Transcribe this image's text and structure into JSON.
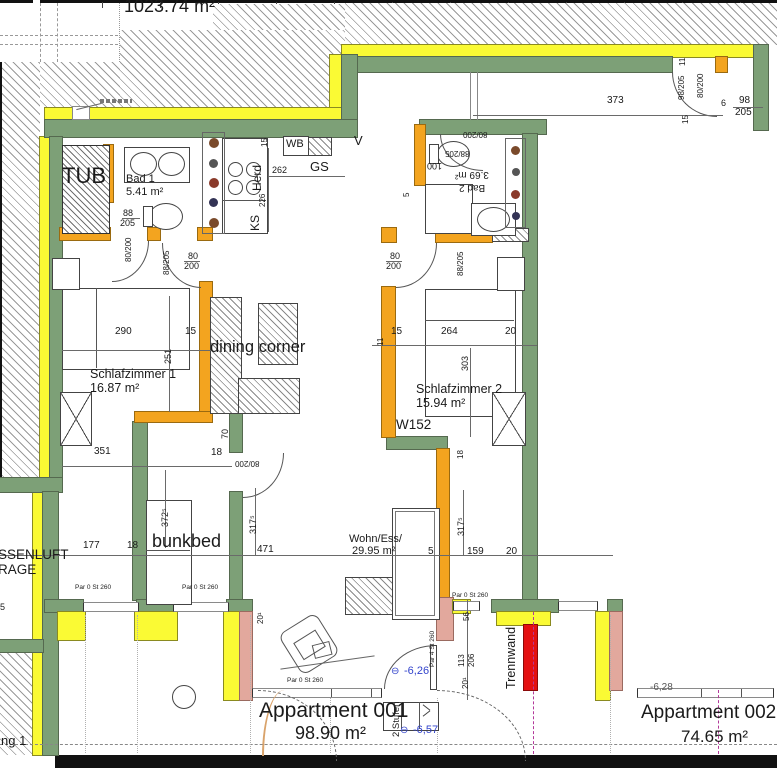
{
  "plan_title": "Apartment floor plan",
  "colors": {
    "wall_green": "#7da077",
    "insulation_yellow": "#fafa34",
    "interior_orange": "#f3a41f",
    "pier_salmon": "#e2a89d",
    "trennwand_red": "#e41112",
    "elevation_blue": "#3344cc"
  },
  "labels": [
    {
      "name": "total-area-label",
      "text": "1023.74 m²",
      "x": 124,
      "y": -3,
      "fs": 18
    },
    {
      "name": "tub-label",
      "text": "TUB",
      "x": 62,
      "y": 165,
      "fs": 22
    },
    {
      "name": "bad1-name",
      "text": "Bad 1",
      "x": 126,
      "y": 174,
      "fs": 11
    },
    {
      "name": "bad1-area",
      "text": "5.41 m²",
      "x": 126,
      "y": 187,
      "fs": 11
    },
    {
      "name": "wb-label",
      "text": "WB",
      "x": 286,
      "y": 139,
      "fs": 11
    },
    {
      "name": "gs-label",
      "text": "GS",
      "x": 310,
      "y": 160,
      "fs": 13
    },
    {
      "name": "herd-label",
      "text": "Herd",
      "x": 251,
      "y": 191,
      "fs": 12,
      "rot": -90
    },
    {
      "name": "ks-label",
      "text": "KS",
      "x": 249,
      "y": 231,
      "fs": 12,
      "rot": -90
    },
    {
      "name": "vent-mark",
      "text": "V",
      "x": 354,
      "y": 134,
      "fs": 13
    },
    {
      "name": "bad2-area",
      "text": "3.69 m²",
      "x": 455,
      "y": 169,
      "fs": 10,
      "rot": 180
    },
    {
      "name": "bad2-name",
      "text": "Bad 2",
      "x": 459,
      "y": 182,
      "fs": 10,
      "rot": 180
    },
    {
      "name": "schlafzimmer1-name",
      "text": "Schlafzimmer 1",
      "x": 90,
      "y": 368,
      "fs": 12.5
    },
    {
      "name": "schlafzimmer1-area",
      "text": "16.87 m²",
      "x": 90,
      "y": 382,
      "fs": 12.5
    },
    {
      "name": "schlafzimmer2-name",
      "text": "Schlafzimmer 2",
      "x": 416,
      "y": 383,
      "fs": 12.5
    },
    {
      "name": "schlafzimmer2-area",
      "text": "15.94 m²",
      "x": 416,
      "y": 397,
      "fs": 12.5
    },
    {
      "name": "w152-label",
      "text": "W152",
      "x": 396,
      "y": 418,
      "fs": 13.5
    },
    {
      "name": "dining-corner-label",
      "text": "dining corner",
      "x": 210,
      "y": 339,
      "fs": 16.5
    },
    {
      "name": "bunkbed-label",
      "text": "bunkbed",
      "x": 152,
      "y": 532,
      "fs": 18
    },
    {
      "name": "wohness-name",
      "text": "Wohn/Ess/",
      "x": 349,
      "y": 534,
      "fs": 11
    },
    {
      "name": "wohness-area",
      "text": "29.95 m²",
      "x": 352,
      "y": 546,
      "fs": 11
    },
    {
      "name": "aussenluft-label",
      "text": "SSENLUFT",
      "x": -2,
      "y": 548,
      "fs": 13.5
    },
    {
      "name": "garage-label",
      "text": "RAGE",
      "x": -2,
      "y": 563,
      "fs": 13.5
    },
    {
      "name": "trennwand-label",
      "text": "Trennwand",
      "x": 505,
      "y": 689,
      "fs": 12.5,
      "rot": -90
    },
    {
      "name": "stufen-label",
      "text": "2 Stufen",
      "x": 392,
      "y": 737,
      "fs": 9.5,
      "rot": -90
    },
    {
      "name": "apartment1-name",
      "text": "Appartment 001",
      "x": 259,
      "y": 700,
      "fs": 21
    },
    {
      "name": "apartment1-area",
      "text": "98.90 m²",
      "x": 295,
      "y": 724,
      "fs": 18
    },
    {
      "name": "apartment2-name",
      "text": "Appartment 002",
      "x": 641,
      "y": 703,
      "fs": 19
    },
    {
      "name": "apartment2-area",
      "text": "74.65 m²",
      "x": 681,
      "y": 728,
      "fs": 17
    },
    {
      "name": "wohnung-label",
      "text": "ng 1",
      "x": 1,
      "y": 734,
      "fs": 13
    },
    {
      "name": "elevation1-symbol",
      "text": "⊖",
      "x": 391,
      "y": 667,
      "fs": 10,
      "color": "#3344cc"
    },
    {
      "name": "elevation1",
      "text": "-6,26",
      "x": 404,
      "y": 666,
      "fs": 11,
      "color": "#3344cc"
    },
    {
      "name": "elevation2-symbol",
      "text": "⊖",
      "x": 400,
      "y": 726,
      "fs": 10,
      "color": "#3344cc"
    },
    {
      "name": "elevation2",
      "text": "-6,57",
      "x": 413,
      "y": 725,
      "fs": 11,
      "color": "#3344cc"
    },
    {
      "name": "elevation3",
      "text": "-6,28",
      "x": 650,
      "y": 683,
      "fs": 10,
      "color": "#555555"
    },
    {
      "name": "parapet1",
      "text": "Par 0 St 260",
      "x": 75,
      "y": 585,
      "fs": 6.5
    },
    {
      "name": "parapet2",
      "text": "Par 0 St 260",
      "x": 182,
      "y": 585,
      "fs": 6.5
    },
    {
      "name": "parapet3",
      "text": "Par 0 St 260",
      "x": 287,
      "y": 678,
      "fs": 6.5
    },
    {
      "name": "parapet4",
      "text": "Par 0 St 260",
      "x": 452,
      "y": 593,
      "fs": 6.5
    },
    {
      "name": "parapet5",
      "text": "Par 4 St 260",
      "x": 430,
      "y": 667,
      "fs": 6.5,
      "rot": -90
    }
  ],
  "dims": [
    {
      "name": "dim-373",
      "text": "373",
      "x": 607,
      "y": 96,
      "fs": 10
    },
    {
      "name": "dim-98-right",
      "text": "98",
      "x": 739,
      "y": 96,
      "fs": 10
    },
    {
      "name": "dim-205-right",
      "text": "205",
      "x": 735,
      "y": 108,
      "fs": 10
    },
    {
      "name": "dim-6",
      "text": "6",
      "x": 721,
      "y": 99,
      "fs": 9
    },
    {
      "name": "dim-door-98-205",
      "text": "98/205",
      "x": 678,
      "y": 100,
      "fs": 8,
      "rot": -90
    },
    {
      "name": "dim-door-80-200-top",
      "text": "80/200",
      "x": 697,
      "y": 98,
      "fs": 8,
      "rot": -90
    },
    {
      "name": "dim-15-top",
      "text": "15",
      "x": 682,
      "y": 124,
      "fs": 8,
      "rot": -90
    },
    {
      "name": "dim-11-top",
      "text": "11",
      "x": 679,
      "y": 66,
      "fs": 8,
      "rot": -90
    },
    {
      "name": "dim-15-kitchen",
      "text": "15",
      "x": 261,
      "y": 147,
      "fs": 8,
      "rot": -90
    },
    {
      "name": "dim-262",
      "text": "262",
      "x": 272,
      "y": 166,
      "fs": 9
    },
    {
      "name": "dim-226",
      "text": "226",
      "x": 259,
      "y": 207,
      "fs": 8,
      "rot": -90
    },
    {
      "name": "dim-88-bad1",
      "text": "88",
      "x": 123,
      "y": 209,
      "fs": 9
    },
    {
      "name": "dim-205-bad1",
      "text": "205",
      "x": 120,
      "y": 219,
      "fs": 9
    },
    {
      "name": "dim-80-200-bad1",
      "text": "80/200",
      "x": 125,
      "y": 262,
      "fs": 8,
      "rot": -90
    },
    {
      "name": "dim-88-205-s1",
      "text": "88/205",
      "x": 163,
      "y": 275,
      "fs": 8,
      "rot": -90
    },
    {
      "name": "dim-80-s1",
      "text": "80",
      "x": 188,
      "y": 252,
      "fs": 9
    },
    {
      "name": "dim-200-s1",
      "text": "200",
      "x": 184,
      "y": 262,
      "fs": 9
    },
    {
      "name": "dim-290",
      "text": "290",
      "x": 115,
      "y": 327,
      "fs": 10
    },
    {
      "name": "dim-251",
      "text": "251",
      "x": 164,
      "y": 364,
      "fs": 9,
      "rot": -90
    },
    {
      "name": "dim-15-s1",
      "text": "15",
      "x": 185,
      "y": 327,
      "fs": 10
    },
    {
      "name": "dim-351",
      "text": "351",
      "x": 94,
      "y": 447,
      "fs": 10
    },
    {
      "name": "dim-18-s1",
      "text": "18",
      "x": 211,
      "y": 448,
      "fs": 10
    },
    {
      "name": "dim-372-5",
      "text": "372⁵",
      "x": 161,
      "y": 527,
      "fs": 9,
      "rot": -90
    },
    {
      "name": "dim-177",
      "text": "177",
      "x": 83,
      "y": 541,
      "fs": 10
    },
    {
      "name": "dim-18-hall",
      "text": "18",
      "x": 127,
      "y": 541,
      "fs": 10
    },
    {
      "name": "dim-471",
      "text": "471",
      "x": 257,
      "y": 545,
      "fs": 10
    },
    {
      "name": "dim-70",
      "text": "70",
      "x": 221,
      "y": 439,
      "fs": 9,
      "rot": -90
    },
    {
      "name": "dim-80-200-hall",
      "text": "80/200",
      "x": 235,
      "y": 459,
      "fs": 8,
      "rot": 180
    },
    {
      "name": "dim-317-5-left",
      "text": "317⁵",
      "x": 249,
      "y": 534,
      "fs": 9,
      "rot": -90
    },
    {
      "name": "dim-20-1-left",
      "text": "20¹",
      "x": 257,
      "y": 624,
      "fs": 8,
      "rot": -90
    },
    {
      "name": "dim-5-win",
      "text": "5",
      "x": 428,
      "y": 547,
      "fs": 10
    },
    {
      "name": "dim-159",
      "text": "159",
      "x": 467,
      "y": 547,
      "fs": 10
    },
    {
      "name": "dim-20-right",
      "text": "20",
      "x": 506,
      "y": 547,
      "fs": 10
    },
    {
      "name": "dim-317-5-right",
      "text": "317⁵",
      "x": 457,
      "y": 536,
      "fs": 9,
      "rot": -90
    },
    {
      "name": "dim-56",
      "text": "56",
      "x": 463,
      "y": 621,
      "fs": 8,
      "rot": -90
    },
    {
      "name": "dim-113",
      "text": "113",
      "x": 458,
      "y": 667,
      "fs": 8,
      "rot": -90
    },
    {
      "name": "dim-206",
      "text": "206",
      "x": 468,
      "y": 667,
      "fs": 8,
      "rot": -90
    },
    {
      "name": "dim-20-1-mid",
      "text": "20¹",
      "x": 462,
      "y": 689,
      "fs": 8,
      "rot": -90
    },
    {
      "name": "dim-15-s2",
      "text": "15",
      "x": 391,
      "y": 327,
      "fs": 10
    },
    {
      "name": "dim-264",
      "text": "264",
      "x": 441,
      "y": 327,
      "fs": 10
    },
    {
      "name": "dim-20-s2",
      "text": "20",
      "x": 505,
      "y": 327,
      "fs": 10
    },
    {
      "name": "dim-11-s2",
      "text": "11",
      "x": 377,
      "y": 346,
      "fs": 8,
      "rot": -90
    },
    {
      "name": "dim-303",
      "text": "303",
      "x": 461,
      "y": 371,
      "fs": 9,
      "rot": -90
    },
    {
      "name": "dim-80-s2",
      "text": "80",
      "x": 390,
      "y": 252,
      "fs": 9
    },
    {
      "name": "dim-200-s2",
      "text": "200",
      "x": 386,
      "y": 262,
      "fs": 9
    },
    {
      "name": "dim-88-205-s2",
      "text": "88/205",
      "x": 457,
      "y": 276,
      "fs": 8,
      "rot": -90
    },
    {
      "name": "dim-18-v",
      "text": "18",
      "x": 457,
      "y": 459,
      "fs": 8,
      "rot": -90
    },
    {
      "name": "dim-100-bad2",
      "text": "100",
      "x": 427,
      "y": 161,
      "fs": 9,
      "rot": 180
    },
    {
      "name": "dim-80-200-bad2",
      "text": "80/200",
      "x": 463,
      "y": 130,
      "fs": 8,
      "rot": 180
    },
    {
      "name": "dim-88-205-bad2",
      "text": "88/205",
      "x": 445,
      "y": 149,
      "fs": 8,
      "rot": 180
    },
    {
      "name": "dim-5-bad2",
      "text": "5",
      "x": 403,
      "y": 197,
      "fs": 8,
      "rot": -90
    },
    {
      "name": "dim-5-left",
      "text": "5",
      "x": 0,
      "y": 603,
      "fs": 9
    }
  ]
}
